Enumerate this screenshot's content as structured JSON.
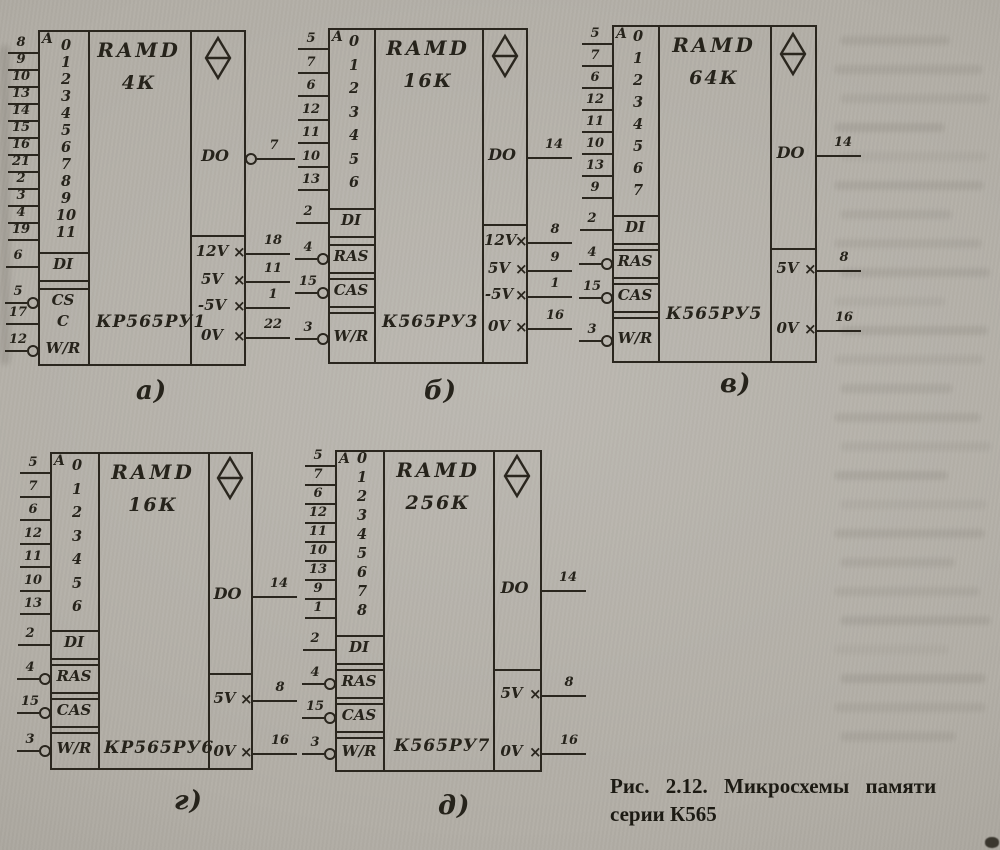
{
  "figure": {
    "caption_line1": "Рис. 2.12. Микросхемы памяти",
    "caption_line2": "серии К565"
  },
  "chips": [
    {
      "caption": "а)",
      "block_type": "RAMD",
      "capacity": "4К",
      "part": "КР565РУ1",
      "addr_letter": "A",
      "addr_bits": [
        "0",
        "1",
        "2",
        "3",
        "4",
        "5",
        "6",
        "7",
        "8",
        "9",
        "10",
        "11"
      ],
      "addr_pins": [
        "8",
        "9",
        "10",
        "13",
        "14",
        "15",
        "16",
        "21",
        "2",
        "3",
        "4",
        "19"
      ],
      "controls": [
        {
          "label": "DI",
          "pin": "6",
          "bubble": false
        },
        {
          "label": "CS",
          "pin": "5",
          "bubble": true
        },
        {
          "label": "C",
          "pin": "17",
          "bubble": false
        },
        {
          "label": "W/R",
          "pin": "12",
          "bubble": true
        }
      ],
      "output": {
        "label": "DO",
        "pin": "7",
        "bubble": true
      },
      "power": [
        {
          "label": "12V",
          "pin": "18"
        },
        {
          "label": "5V",
          "pin": "11"
        },
        {
          "label": "-5V",
          "pin": "1"
        },
        {
          "label": "0V",
          "pin": "22"
        }
      ]
    },
    {
      "caption": "б)",
      "block_type": "RAMD",
      "capacity": "16К",
      "part": "К565РУ3",
      "addr_letter": "A",
      "addr_bits": [
        "0",
        "1",
        "2",
        "3",
        "4",
        "5",
        "6"
      ],
      "addr_pins": [
        "5",
        "7",
        "6",
        "12",
        "11",
        "10",
        "13"
      ],
      "controls": [
        {
          "label": "DI",
          "pin": "2",
          "bubble": false
        },
        {
          "label": "RAS",
          "pin": "4",
          "bubble": true
        },
        {
          "label": "CAS",
          "pin": "15",
          "bubble": true
        },
        {
          "label": "W/R",
          "pin": "3",
          "bubble": true
        }
      ],
      "output": {
        "label": "DO",
        "pin": "14",
        "bubble": false
      },
      "power": [
        {
          "label": "12V",
          "pin": "8"
        },
        {
          "label": "5V",
          "pin": "9"
        },
        {
          "label": "-5V",
          "pin": "1"
        },
        {
          "label": "0V",
          "pin": "16"
        }
      ]
    },
    {
      "caption": "в)",
      "block_type": "RAMD",
      "capacity": "64К",
      "part": "К565РУ5",
      "addr_letter": "A",
      "addr_bits": [
        "0",
        "1",
        "2",
        "3",
        "4",
        "5",
        "6",
        "7"
      ],
      "addr_pins": [
        "5",
        "7",
        "6",
        "12",
        "11",
        "10",
        "13",
        "9"
      ],
      "controls": [
        {
          "label": "DI",
          "pin": "2",
          "bubble": false
        },
        {
          "label": "RAS",
          "pin": "4",
          "bubble": true
        },
        {
          "label": "CAS",
          "pin": "15",
          "bubble": true
        },
        {
          "label": "W/R",
          "pin": "3",
          "bubble": true
        }
      ],
      "output": {
        "label": "DO",
        "pin": "14",
        "bubble": false
      },
      "power": [
        {
          "label": "5V",
          "pin": "8"
        },
        {
          "label": "0V",
          "pin": "16"
        }
      ]
    },
    {
      "caption": "г)",
      "block_type": "RAMD",
      "capacity": "16К",
      "part": "КР565РУ6",
      "addr_letter": "A",
      "addr_bits": [
        "0",
        "1",
        "2",
        "3",
        "4",
        "5",
        "6"
      ],
      "addr_pins": [
        "5",
        "7",
        "6",
        "12",
        "11",
        "10",
        "13"
      ],
      "controls": [
        {
          "label": "DI",
          "pin": "2",
          "bubble": false
        },
        {
          "label": "RAS",
          "pin": "4",
          "bubble": true
        },
        {
          "label": "CAS",
          "pin": "15",
          "bubble": true
        },
        {
          "label": "W/R",
          "pin": "3",
          "bubble": true
        }
      ],
      "output": {
        "label": "DO",
        "pin": "14",
        "bubble": false
      },
      "power": [
        {
          "label": "5V",
          "pin": "8"
        },
        {
          "label": "0V",
          "pin": "16"
        }
      ]
    },
    {
      "caption": "д)",
      "block_type": "RAMD",
      "capacity": "256К",
      "part": "К565РУ7",
      "addr_letter": "A",
      "addr_bits": [
        "0",
        "1",
        "2",
        "3",
        "4",
        "5",
        "6",
        "7",
        "8"
      ],
      "addr_pins": [
        "5",
        "7",
        "6",
        "12",
        "11",
        "10",
        "13",
        "9",
        "1"
      ],
      "controls": [
        {
          "label": "DI",
          "pin": "2",
          "bubble": false
        },
        {
          "label": "RAS",
          "pin": "4",
          "bubble": true
        },
        {
          "label": "CAS",
          "pin": "15",
          "bubble": true
        },
        {
          "label": "W/R",
          "pin": "3",
          "bubble": true
        }
      ],
      "output": {
        "label": "DO",
        "pin": "14",
        "bubble": false
      },
      "power": [
        {
          "label": "5V",
          "pin": "8"
        },
        {
          "label": "0V",
          "pin": "16"
        }
      ]
    }
  ]
}
